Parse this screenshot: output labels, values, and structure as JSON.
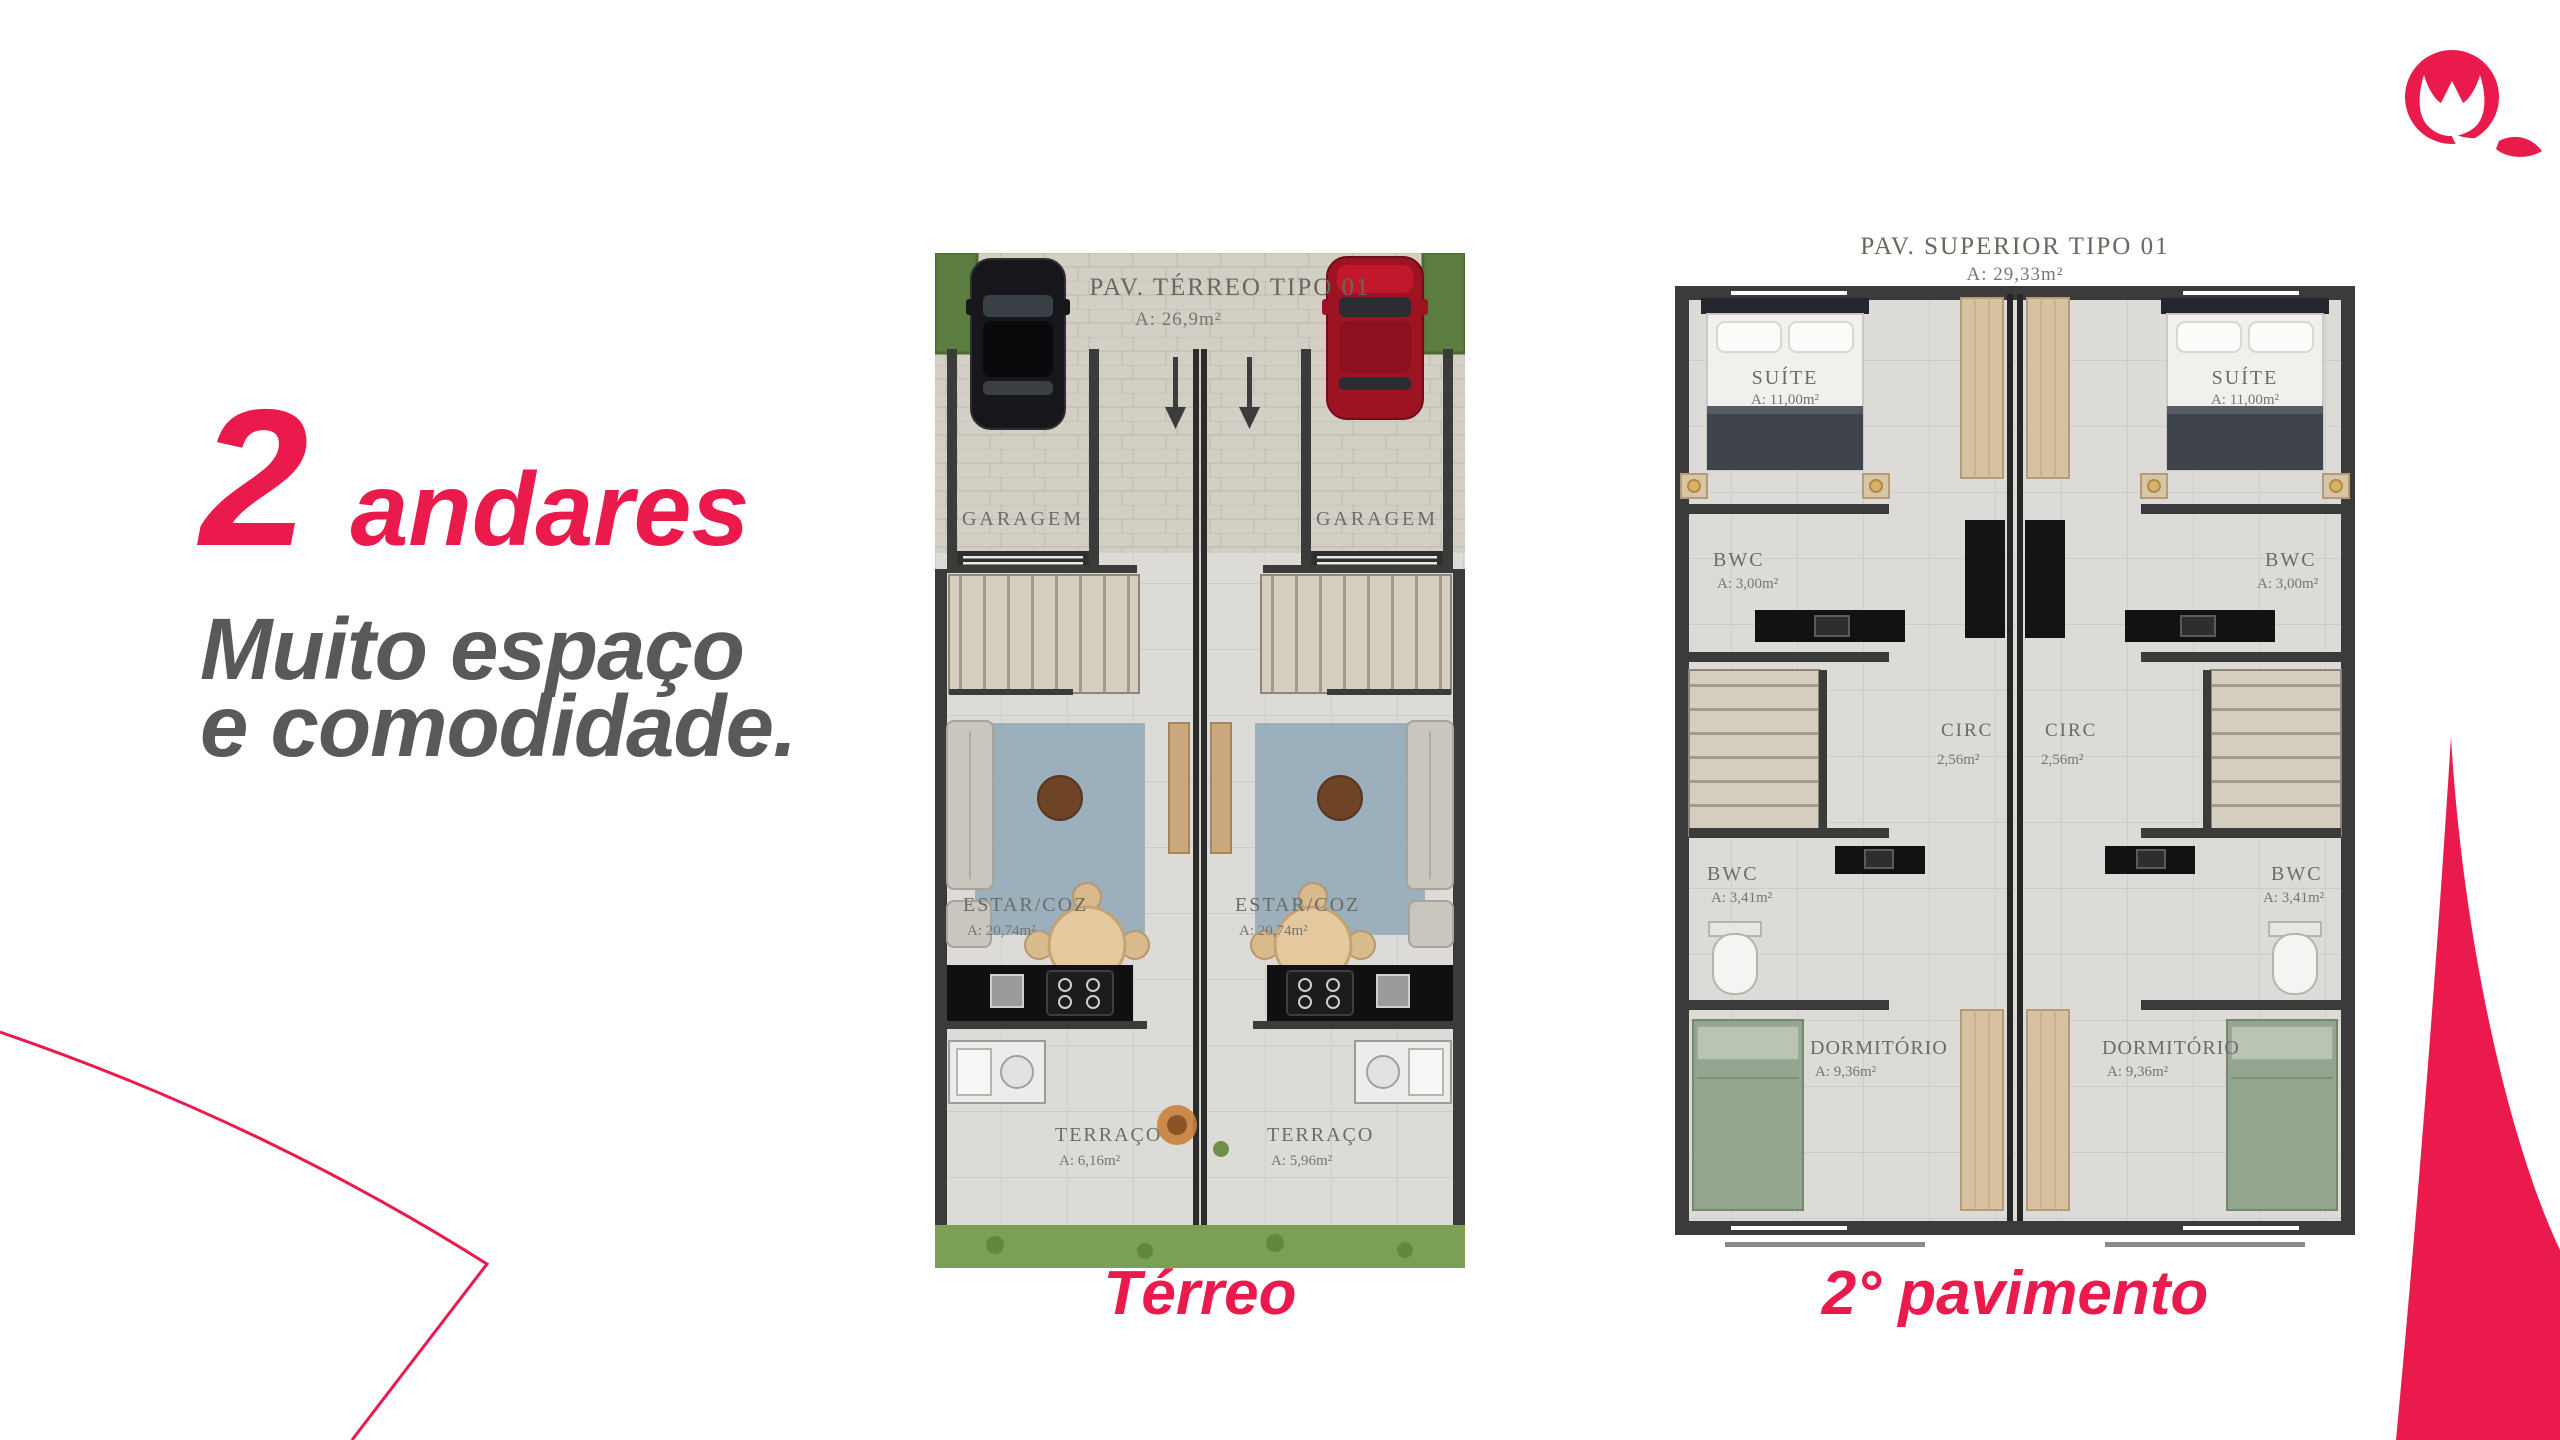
{
  "colors": {
    "accent": "#EA1A4C",
    "headline_gray": "#58595B",
    "wall": "#3B3B3B",
    "tile": "#DCDBD7",
    "pavement": "#D3CFC5",
    "grass": "#7AA054",
    "rug": "#8FA7B7",
    "stair": "#D6CEC0",
    "wood": "#D7C1A0",
    "bed_green": "#93A48F"
  },
  "headline": {
    "big_number": "2",
    "big_word": "andares",
    "line1": "Muito espaço",
    "line2": "e comodidade."
  },
  "plans": {
    "terreo": {
      "title": "PAV. TÉRREO TIPO 01",
      "area": "A: 26,9m²",
      "caption": "Térreo",
      "labels": {
        "garagem_l": "GARAGEM",
        "garagem_r": "GARAGEM",
        "estar_l": "ESTAR/COZ",
        "estar_l_area": "A: 20,74m²",
        "estar_r": "ESTAR/COZ",
        "estar_r_area": "A: 20,74m²",
        "terraco_l": "TERRAÇO",
        "terraco_l_area": "A: 6,16m²",
        "terraco_r": "TERRAÇO",
        "terraco_r_area": "A: 5,96m²"
      }
    },
    "superior": {
      "title": "PAV. SUPERIOR TIPO 01",
      "area": "A: 29,33m²",
      "caption": "2° pavimento",
      "labels": {
        "suite_l": "SUÍTE",
        "suite_l_area": "A: 11,00m²",
        "suite_r": "SUÍTE",
        "suite_r_area": "A: 11,00m²",
        "bwc1_l": "BWC",
        "bwc1_l_area": "A: 3,00m²",
        "bwc1_r": "BWC",
        "bwc1_r_area": "A: 3,00m²",
        "circ_l": "CIRC",
        "circ_l_area": "2,56m²",
        "circ_r": "CIRC",
        "circ_r_area": "2,56m²",
        "bwc2_l": "BWC",
        "bwc2_l_area": "A: 3,41m²",
        "bwc2_r": "BWC",
        "bwc2_r_area": "A: 3,41m²",
        "dorm_l": "DORMITÓRIO",
        "dorm_l_area": "A: 9,36m²",
        "dorm_r": "DORMITÓRIO",
        "dorm_r_area": "A: 9,36m²"
      }
    }
  }
}
